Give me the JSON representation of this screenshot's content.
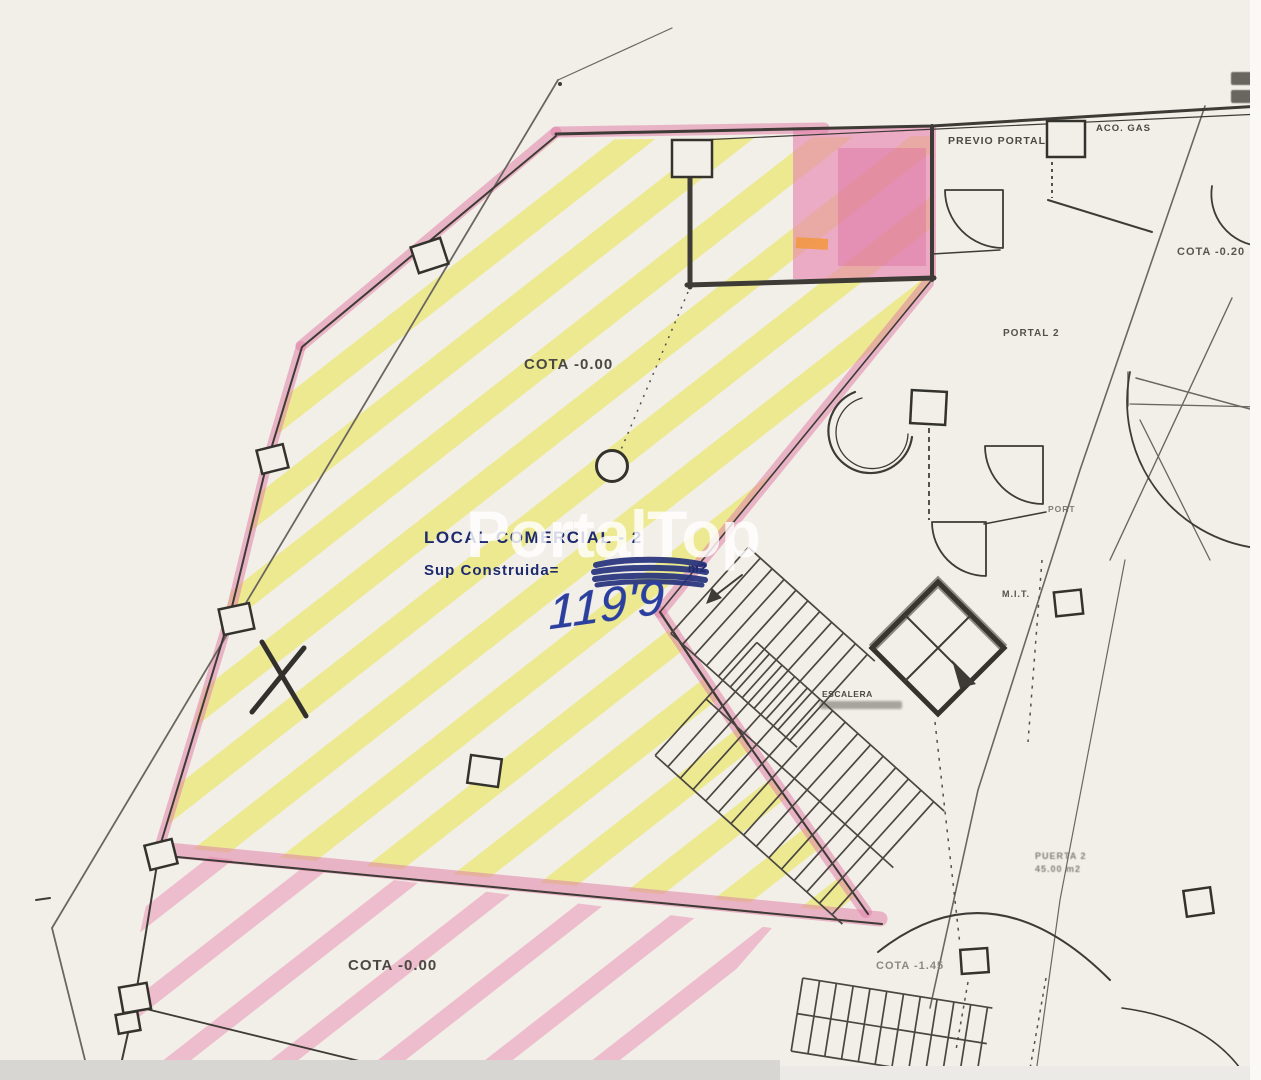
{
  "labels": {
    "cota_main": "COTA -0.00",
    "cota_lower": "COTA -0.00",
    "cota_right": "COTA -0.20",
    "cota_entry": "COTA -1.45",
    "previo_portal": "PREVIO PORTAL",
    "portal_2": "PORTAL 2",
    "gas_meter": "ACO. GAS",
    "rit_room": "M.I.T.",
    "port_note": "PORT",
    "stair_label": "ESCALERA",
    "door_note_line1": "PUERTA 2",
    "door_note_line2": "45.00 m2"
  },
  "stamp": {
    "title": "LOCAL COMERCIAL - 2",
    "surface_label": "Sup Construida=",
    "surface_unit": "m2",
    "handwritten_area": "119'9"
  },
  "watermark": {
    "text": "PortalTop"
  },
  "colors": {
    "paper": "#f2efe9",
    "ink": "#3e3b36",
    "highlight_yellow": "#e8e448",
    "highlight_pink": "#e28cb2",
    "stamp_navy": "#1d2b6e",
    "handwriting_blue": "#2b3f9e"
  }
}
